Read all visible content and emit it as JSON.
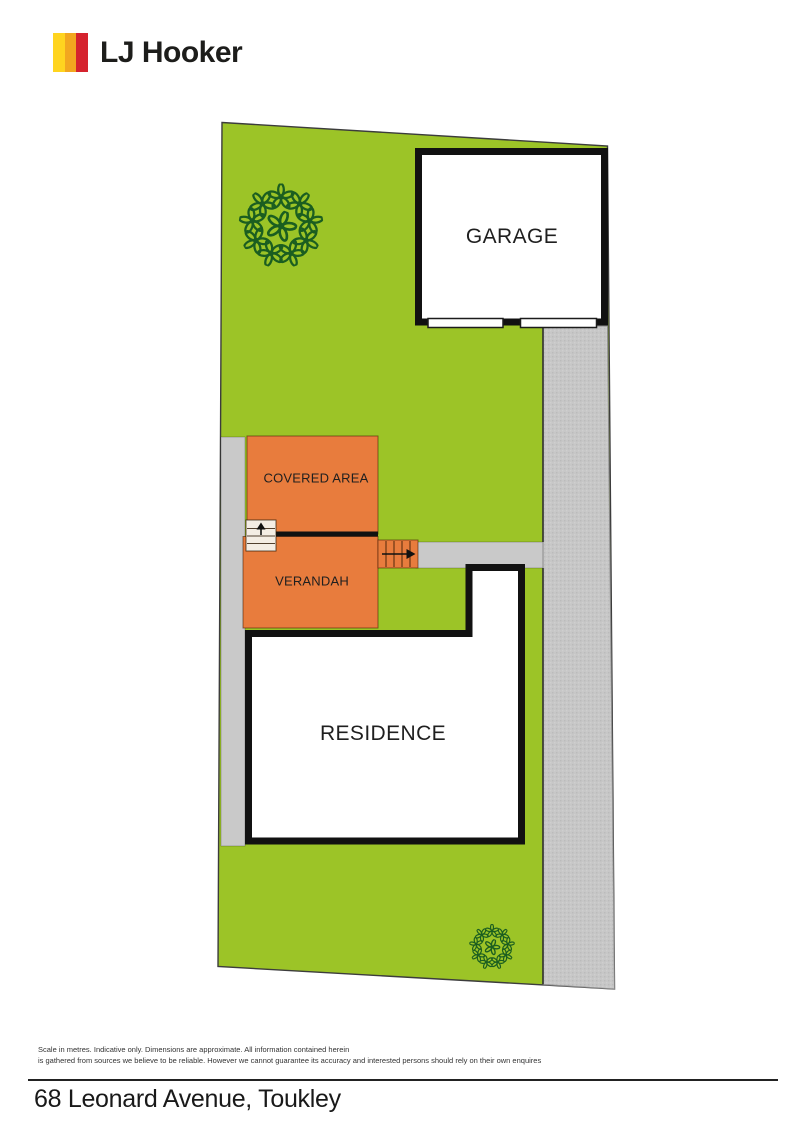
{
  "logo": {
    "brand": "LJ Hooker"
  },
  "plan": {
    "labels": {
      "garage": "GARAGE",
      "covered_area": "COVERED AREA",
      "verandah": "VERANDAH",
      "residence": "RESIDENCE"
    },
    "plants": [
      {
        "cx": 281,
        "cy": 226,
        "ring": 29,
        "count": 9,
        "size": 27
      },
      {
        "cx": 492,
        "cy": 947,
        "ring": 16,
        "count": 9,
        "size": 14
      }
    ]
  },
  "colors": {
    "brand_yellow": "#FFD41F",
    "brand_amber": "#F2A71F",
    "brand_red": "#D5232E",
    "ink": "#1D1D1B",
    "grass": "#9CC427",
    "deck": "#E87C3D",
    "paving": "#C9C9C9",
    "driveway": "#C7C7C7",
    "wall": "#111111",
    "plant": "#1B5E20"
  },
  "footer": {
    "disclaimer_line1": "Scale in metres. Indicative only. Dimensions are approximate. All information contained herein",
    "disclaimer_line2": "is gathered from sources we believe to be reliable. However we cannot guarantee its accuracy and interested persons should rely on their own enquires",
    "address": "68 Leonard Avenue, Toukley"
  }
}
